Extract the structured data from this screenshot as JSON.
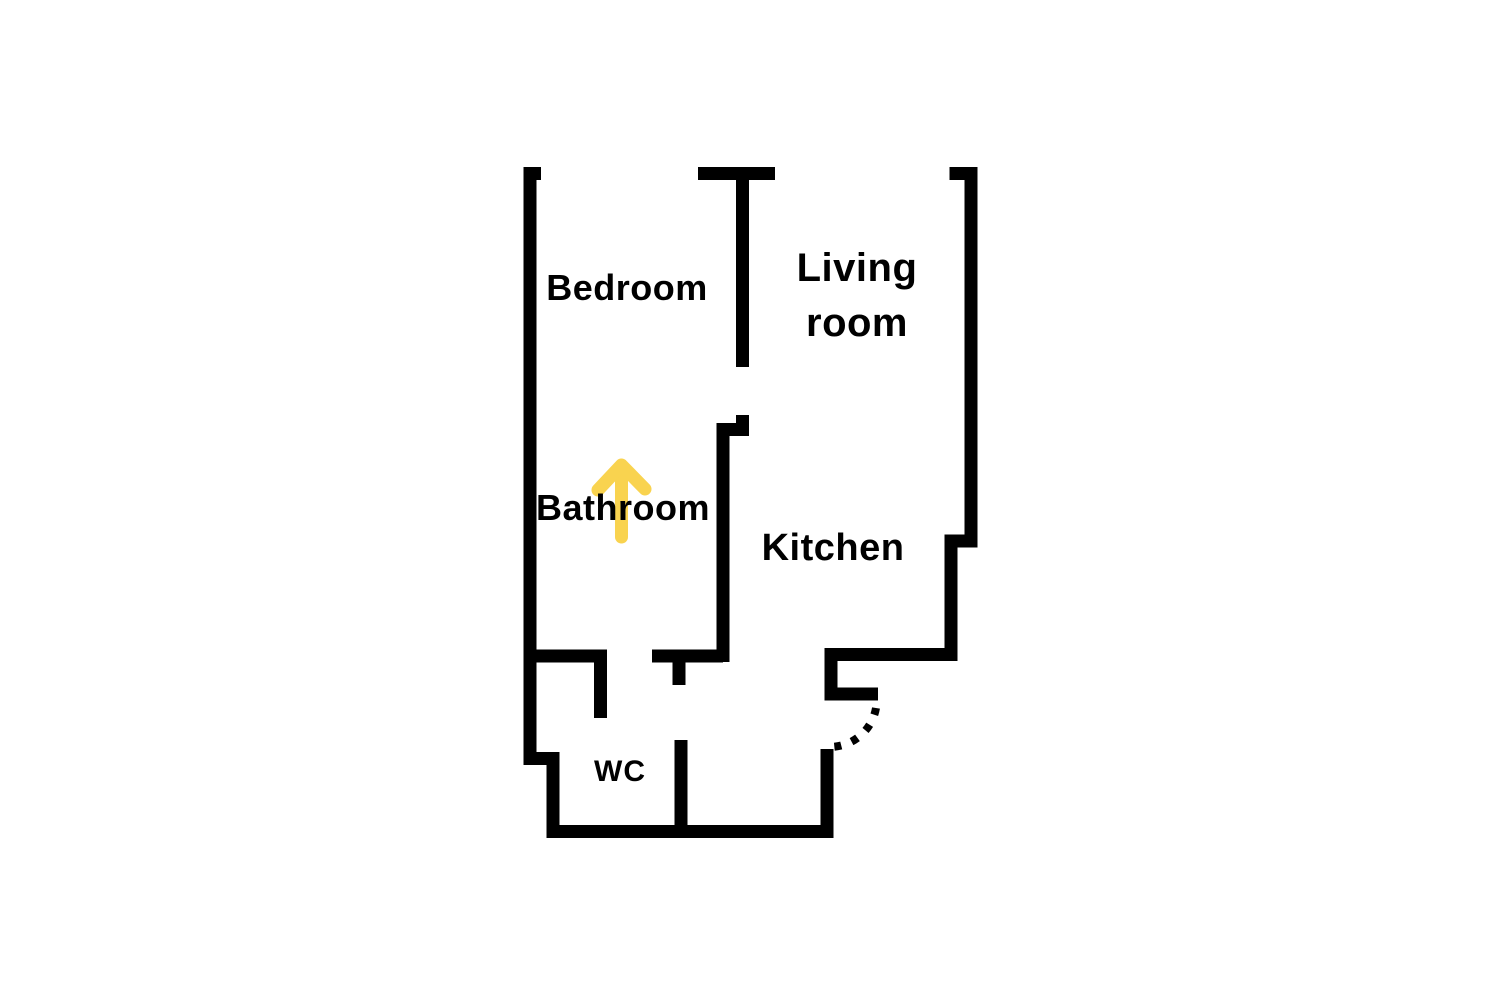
{
  "floor_plan": {
    "type": "apartment-floor-plan",
    "background": "#FFFFFF",
    "wall_color": "#000000",
    "text_color": "#000000",
    "rooms": [
      {
        "id": "bedroom",
        "label": "Bedroom"
      },
      {
        "id": "living-room",
        "label_line1": "Living",
        "label_line2": "room"
      },
      {
        "id": "bathroom",
        "label": "Bathroom"
      },
      {
        "id": "kitchen",
        "label": "Kitchen"
      },
      {
        "id": "wc",
        "label": "WC"
      }
    ],
    "door": {
      "style": "dashed-quarter-arc",
      "location": "kitchen-entrance"
    },
    "arrow": {
      "icon": "arrow-up-icon",
      "direction": "up",
      "color": "#F9D34F",
      "location": "bathroom"
    }
  }
}
